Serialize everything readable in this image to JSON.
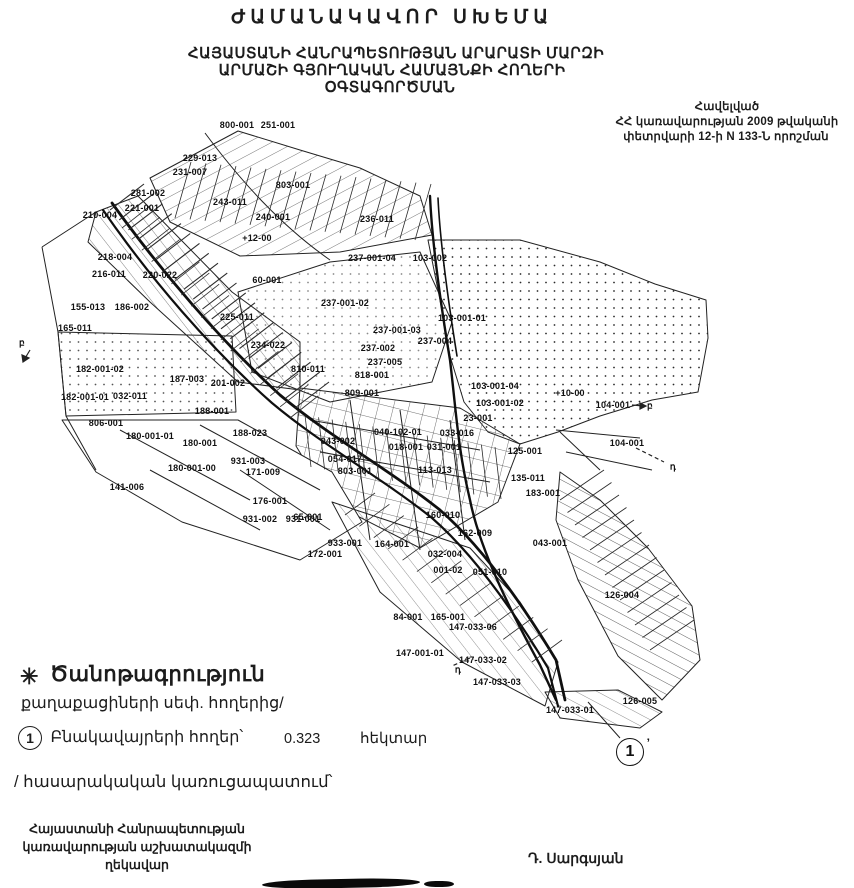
{
  "colors": {
    "ink": "#1c1c1c",
    "paper": "#ffffff"
  },
  "title": "ԺԱՄԱՆԱԿԱՎՈՐ ՍԽԵՄԱ",
  "subtitle": {
    "line1": "ՀԱՅԱՍՏԱՆԻ ՀԱՆՐԱՊԵՏՈՒԹՅԱՆ ԱՐԱՐԱՏԻ ՄԱՐԶԻ",
    "line2": "ԱՐՄԱՇԻ ԳՅՈՒՂԱԿԱՆ ՀԱՄԱՅՆՔԻ ՀՈՂԵՐԻ",
    "line3": "ՕԳՏԱԳՈՐԾՄԱՆ"
  },
  "annex": {
    "line1": "Հավելված",
    "line2": "ՀՀ կառավարության 2009 թվականի",
    "line3": "փետրվարի 12-ի N 133-Ն որոշման"
  },
  "legend": {
    "star": "✳",
    "heading": "Ծանոթագրություն",
    "subheading": "քաղաքացիների սեփ. հողերից/",
    "item_number": "1",
    "item_label": "Բնակավայրերի հողեր՝",
    "item_value": "0.323",
    "item_unit": "հեկտար",
    "note": "/ հասարակական կառուցապատում՝"
  },
  "footer": {
    "left_line1": "Հայաստանի Հանրապետության",
    "left_line2": "կառավարության աշխատակազմի",
    "left_line3": "ղեկավար",
    "signature": "Դ. Սարգսյան"
  },
  "map": {
    "marker_number": "1",
    "marker_suffix": "’",
    "labels": [
      {
        "text": "800-001",
        "x": 237,
        "y": 125
      },
      {
        "text": "251-001",
        "x": 278,
        "y": 125
      },
      {
        "text": "229-013",
        "x": 200,
        "y": 158
      },
      {
        "text": "231-007",
        "x": 190,
        "y": 172
      },
      {
        "text": "803-001",
        "x": 293,
        "y": 185
      },
      {
        "text": "281-002",
        "x": 148,
        "y": 193
      },
      {
        "text": "243-011",
        "x": 230,
        "y": 202
      },
      {
        "text": "221-001",
        "x": 142,
        "y": 208
      },
      {
        "text": "210-004",
        "x": 100,
        "y": 215
      },
      {
        "text": "240-001",
        "x": 273,
        "y": 217
      },
      {
        "text": "236-011",
        "x": 377,
        "y": 219
      },
      {
        "text": "+12-00",
        "x": 257,
        "y": 238
      },
      {
        "text": "218-004",
        "x": 115,
        "y": 257
      },
      {
        "text": "237-001-04",
        "x": 372,
        "y": 258
      },
      {
        "text": "103-002",
        "x": 430,
        "y": 258
      },
      {
        "text": "216-011",
        "x": 109,
        "y": 274
      },
      {
        "text": "220-022",
        "x": 160,
        "y": 275
      },
      {
        "text": "60-001",
        "x": 267,
        "y": 280
      },
      {
        "text": "237-001-02",
        "x": 345,
        "y": 303
      },
      {
        "text": "155-013",
        "x": 88,
        "y": 307
      },
      {
        "text": "186-002",
        "x": 132,
        "y": 307
      },
      {
        "text": "225-011",
        "x": 237,
        "y": 317
      },
      {
        "text": "103-001-01",
        "x": 462,
        "y": 318
      },
      {
        "text": "165-011",
        "x": 75,
        "y": 328
      },
      {
        "text": "237-001-03",
        "x": 397,
        "y": 330
      },
      {
        "text": "237-004",
        "x": 435,
        "y": 341
      },
      {
        "text": "234-022",
        "x": 268,
        "y": 345
      },
      {
        "text": "237-002",
        "x": 378,
        "y": 348
      },
      {
        "text": "237-005",
        "x": 385,
        "y": 362
      },
      {
        "text": "810-011",
        "x": 308,
        "y": 369
      },
      {
        "text": "182-001-02",
        "x": 100,
        "y": 369
      },
      {
        "text": "818-001",
        "x": 372,
        "y": 375
      },
      {
        "text": "187-003",
        "x": 187,
        "y": 379
      },
      {
        "text": "201-002",
        "x": 228,
        "y": 383
      },
      {
        "text": "103-001-04",
        "x": 495,
        "y": 386
      },
      {
        "text": "+10-00",
        "x": 570,
        "y": 393
      },
      {
        "text": "809-001",
        "x": 362,
        "y": 393
      },
      {
        "text": "182-001-01",
        "x": 85,
        "y": 397
      },
      {
        "text": "032-011",
        "x": 130,
        "y": 396
      },
      {
        "text": "103-001-02",
        "x": 500,
        "y": 403
      },
      {
        "text": "104-001",
        "x": 613,
        "y": 405
      },
      {
        "text": "188-001",
        "x": 212,
        "y": 411
      },
      {
        "text": "23-001",
        "x": 478,
        "y": 418
      },
      {
        "text": "806-001",
        "x": 106,
        "y": 423
      },
      {
        "text": "040-102-01",
        "x": 398,
        "y": 432
      },
      {
        "text": "033-016",
        "x": 457,
        "y": 433
      },
      {
        "text": "188-023",
        "x": 250,
        "y": 433
      },
      {
        "text": "180-001-01",
        "x": 150,
        "y": 436
      },
      {
        "text": "043-002",
        "x": 338,
        "y": 441
      },
      {
        "text": "104-001",
        "x": 627,
        "y": 443
      },
      {
        "text": "180-001",
        "x": 200,
        "y": 443
      },
      {
        "text": "018-001",
        "x": 406,
        "y": 447
      },
      {
        "text": "031-001",
        "x": 444,
        "y": 447
      },
      {
        "text": "125-001",
        "x": 525,
        "y": 451
      },
      {
        "text": "054-017",
        "x": 345,
        "y": 459
      },
      {
        "text": "931-003",
        "x": 248,
        "y": 461
      },
      {
        "text": "180-001-00",
        "x": 192,
        "y": 468
      },
      {
        "text": "113-013",
        "x": 435,
        "y": 470
      },
      {
        "text": "803-001",
        "x": 355,
        "y": 471
      },
      {
        "text": "171-009",
        "x": 263,
        "y": 472
      },
      {
        "text": "135-011",
        "x": 528,
        "y": 478
      },
      {
        "text": "141-006",
        "x": 127,
        "y": 487
      },
      {
        "text": "183-001",
        "x": 543,
        "y": 493
      },
      {
        "text": "176-001",
        "x": 270,
        "y": 501
      },
      {
        "text": "160-010",
        "x": 443,
        "y": 515
      },
      {
        "text": "65-001",
        "x": 308,
        "y": 517
      },
      {
        "text": "931-002",
        "x": 260,
        "y": 519
      },
      {
        "text": "931-001",
        "x": 303,
        "y": 519
      },
      {
        "text": "162-009",
        "x": 475,
        "y": 533
      },
      {
        "text": "043-001",
        "x": 550,
        "y": 543
      },
      {
        "text": "933-001",
        "x": 345,
        "y": 543
      },
      {
        "text": "164-001",
        "x": 392,
        "y": 544
      },
      {
        "text": "172-001",
        "x": 325,
        "y": 554
      },
      {
        "text": "032-004",
        "x": 445,
        "y": 554
      },
      {
        "text": "001-02",
        "x": 448,
        "y": 570
      },
      {
        "text": "051-010",
        "x": 490,
        "y": 572
      },
      {
        "text": "126-004",
        "x": 622,
        "y": 595
      },
      {
        "text": "84-001",
        "x": 408,
        "y": 617
      },
      {
        "text": "165-001",
        "x": 448,
        "y": 617
      },
      {
        "text": "147-033-06",
        "x": 473,
        "y": 627
      },
      {
        "text": "147-001-01",
        "x": 420,
        "y": 653
      },
      {
        "text": "147-033-02",
        "x": 483,
        "y": 660
      },
      {
        "text": "147-033-03",
        "x": 497,
        "y": 682
      },
      {
        "text": "126-005",
        "x": 640,
        "y": 701
      },
      {
        "text": "147-033-01",
        "x": 570,
        "y": 710
      },
      {
        "text": "բ",
        "x": 22,
        "y": 343
      },
      {
        "text": "բ",
        "x": 650,
        "y": 406
      },
      {
        "text": "դ",
        "x": 673,
        "y": 467
      },
      {
        "text": "դ",
        "x": 458,
        "y": 670
      }
    ]
  }
}
